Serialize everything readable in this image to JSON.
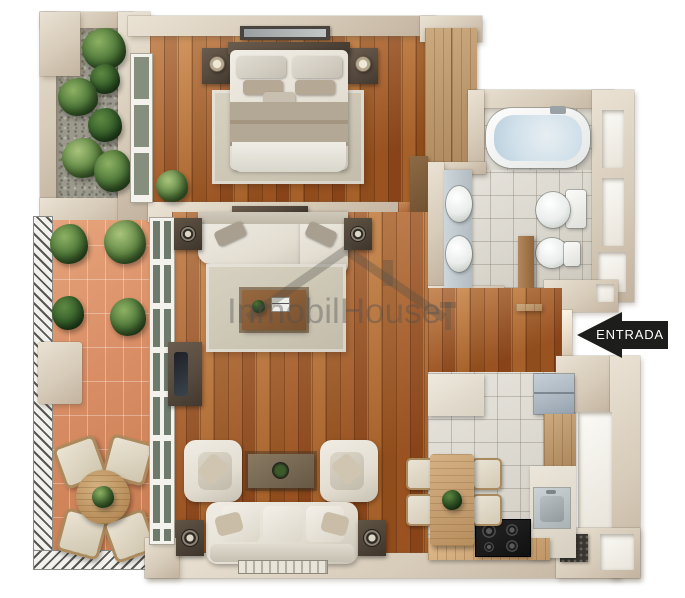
{
  "entrance": {
    "label": "ENTRADA",
    "arrow_direction": "left",
    "bg_color": "#1d1d1b",
    "text_color": "#ffffff"
  },
  "watermark": {
    "text": "InmobilHouse",
    "icon": "house-roof-icon",
    "color": "rgba(80,80,80,0.40)"
  },
  "palette": {
    "wall": "#d7cbb9",
    "wall_light": "#eae2d4",
    "wood_dark": "#9a4f1e",
    "wood_mid": "#b06028",
    "wood_light": "#c17434",
    "terracotta": "#d98e66",
    "tile": "#d9d6cd",
    "water": "#cfdfe9",
    "fridge": "#adb8c2",
    "plant": "#4a7436",
    "fabric": "#e3ddd1",
    "dark_wood": "#55493d",
    "arrow": "#1d1d1b"
  },
  "rooms": {
    "bedroom": [
      "double-bed",
      "headboard",
      "pillows",
      "blanket",
      "nightstand-left",
      "nightstand-right",
      "table-lamp-left",
      "table-lamp-right",
      "area-rug",
      "wall-picture",
      "wardrobe",
      "dresser",
      "potted-plant",
      "window"
    ],
    "bathroom": [
      "bathtub",
      "washbasin-top",
      "washbasin-bottom",
      "toilet",
      "bidet",
      "wooden-door",
      "wall-niches"
    ],
    "living_room": [
      "sectional-sofa",
      "speaker-top-left",
      "speaker-top-right",
      "area-rug",
      "coffee-table",
      "tv-stand",
      "armchair-left",
      "armchair-right",
      "side-table",
      "three-seat-sofa",
      "speaker-bottom-left",
      "speaker-bottom-right",
      "doormat",
      "media-shelf"
    ],
    "kitchen": [
      "fridge",
      "stove",
      "kitchen-sink",
      "upper-counter",
      "side-counter",
      "bottom-counter",
      "dining-table",
      "dining-chairs-x4",
      "alcove-shelf",
      "utility-alcove"
    ],
    "terrace": [
      "railing-left",
      "railing-bottom",
      "outdoor-round-table",
      "outdoor-chairs-x4",
      "storage-box",
      "plants"
    ],
    "garden": [
      "gravel-bed",
      "plants"
    ],
    "hall": [
      "entrance-opening",
      "threshold"
    ]
  }
}
